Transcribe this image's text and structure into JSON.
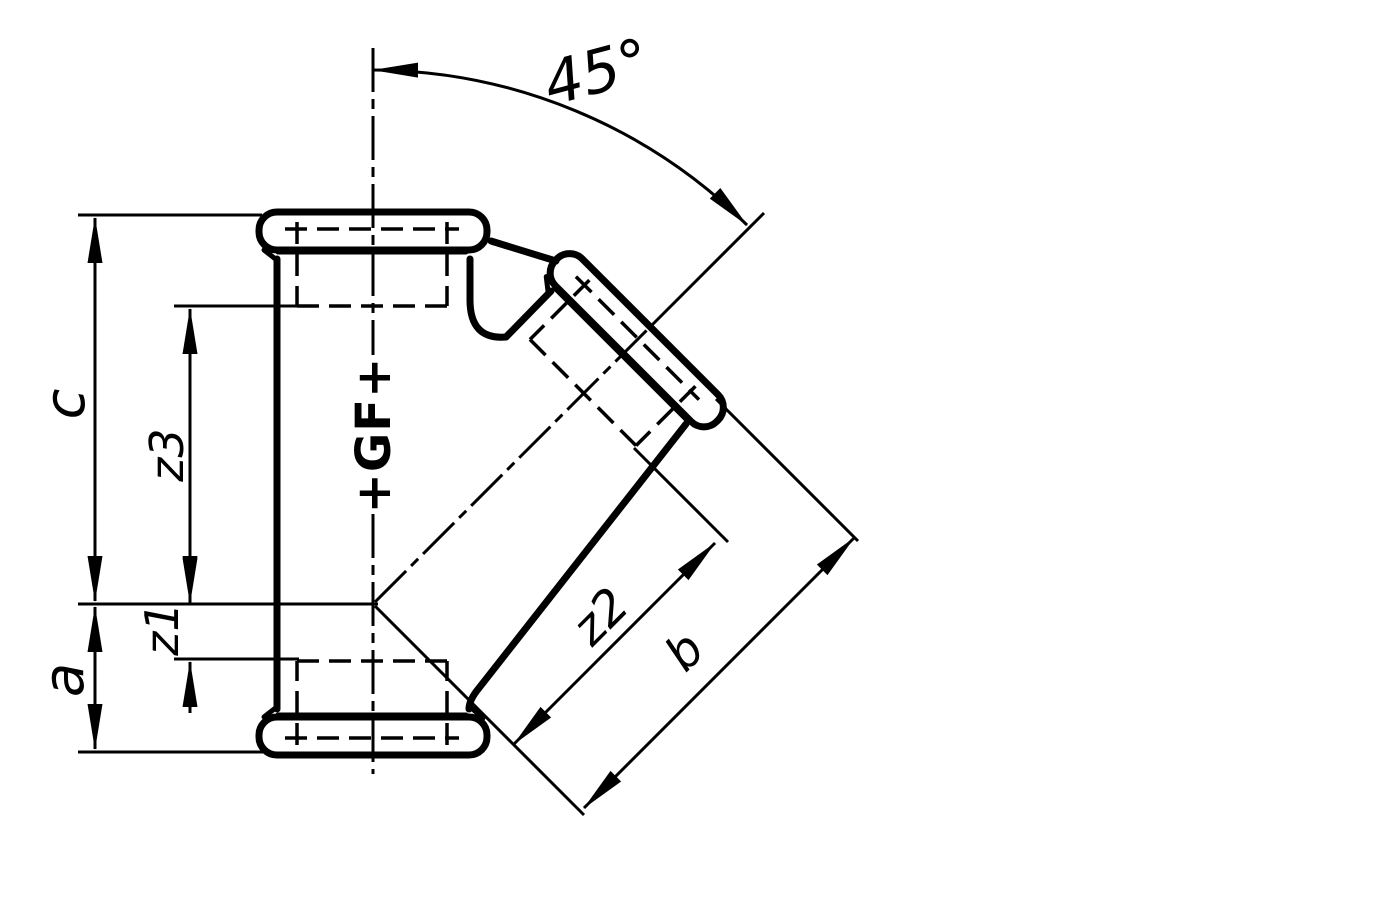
{
  "drawing": {
    "description": "Technical dimension drawing of a 45-degree female-threaded branch pipe fitting",
    "angle_label": "45°",
    "logo_text": "+GF+",
    "labels": {
      "c": "c",
      "z3": "z3",
      "z1": "z1",
      "a": "a",
      "z2": "z2",
      "b": "b"
    },
    "colors": {
      "ink": "#000000",
      "paper": "#ffffff"
    }
  }
}
